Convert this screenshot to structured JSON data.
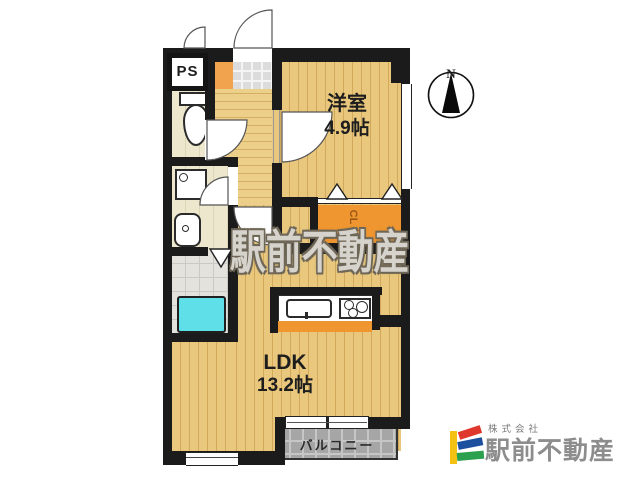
{
  "floor_plan": {
    "rooms": {
      "ps": {
        "label": "PS"
      },
      "western_room": {
        "label": "洋室",
        "size": "4.9帖"
      },
      "ldk": {
        "label": "LDK",
        "size": "13.2帖"
      },
      "closet": {
        "label": "CL"
      },
      "balcony": {
        "label": "バルコニー"
      }
    },
    "compass": {
      "label": "N"
    },
    "fixtures": [
      "toilet",
      "washing-machine-pan",
      "washbasin",
      "bathtub",
      "kitchen-sink",
      "gas-stove",
      "kitchen-counter"
    ],
    "colors": {
      "wall": "#1b1b1b",
      "wood_floor": "#e9c87e",
      "accent_orange": "#ef9630",
      "bathtub_cyan": "#5fe0e8",
      "balcony_gray": "#a6a6a6",
      "entrance_tile": "#dcdcdc"
    }
  },
  "watermark": {
    "text": "駅前不動産"
  },
  "logo": {
    "company_prefix": "株式会社",
    "company_name": "駅前不動産",
    "colors": {
      "yellow": "#f3c212",
      "red": "#df372b",
      "blue": "#1d4f9f",
      "green": "#2ba04e",
      "text_gray": "#8d8d8d"
    }
  }
}
